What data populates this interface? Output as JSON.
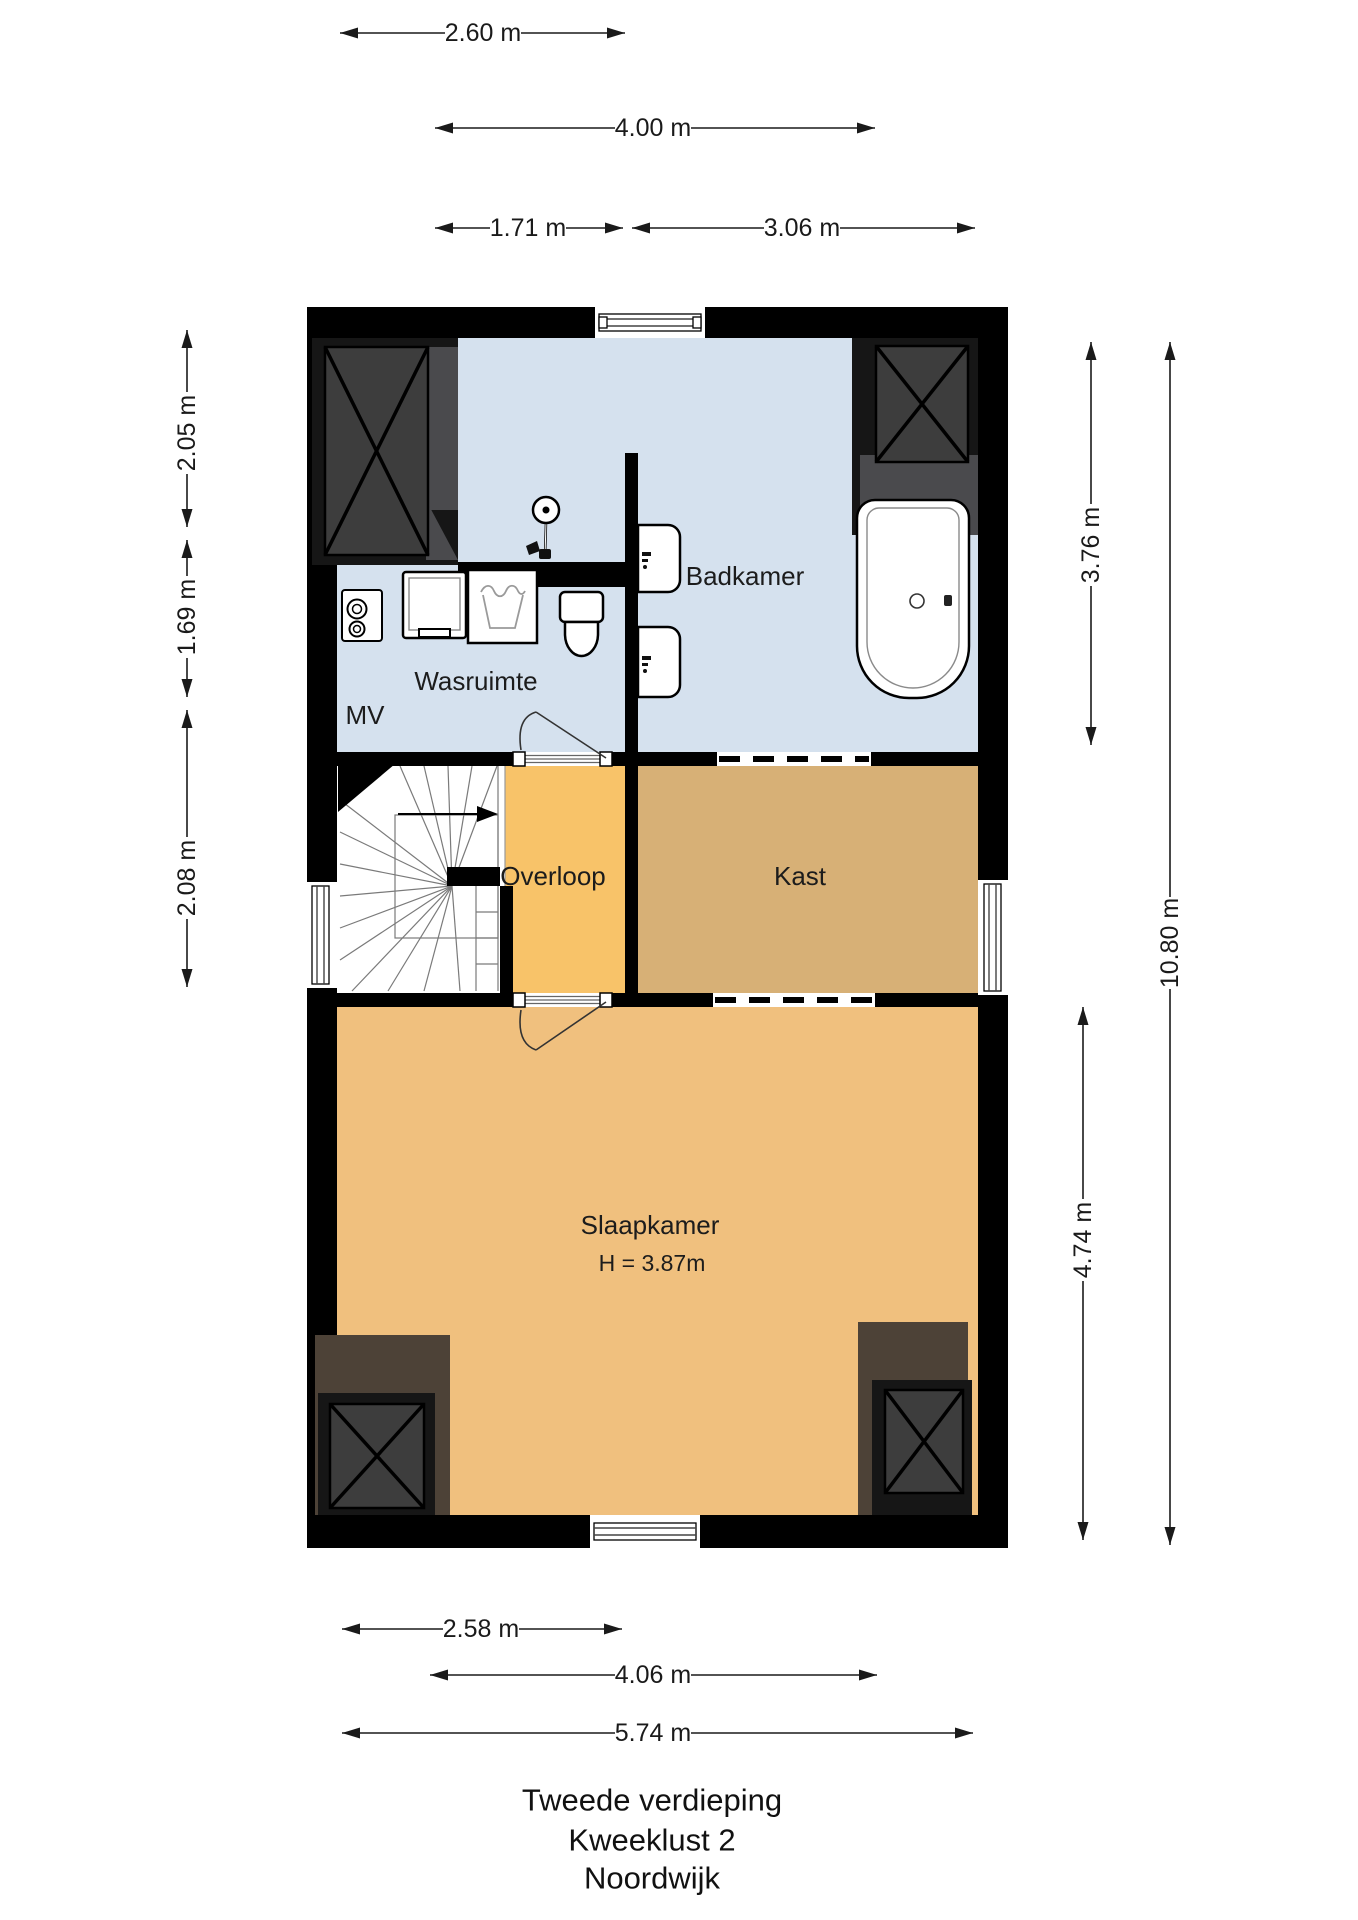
{
  "title": {
    "line1": "Tweede verdieping",
    "line2": "Kweeklust 2",
    "line3": "Noordwijk"
  },
  "rooms": {
    "badkamer": "Badkamer",
    "wasruimte": "Wasruimte",
    "mv": "MV",
    "overloop": "Overloop",
    "kast": "Kast",
    "slaapkamer": "Slaapkamer",
    "slaapkamer_height": "H = 3.87m"
  },
  "dimensions": {
    "top": [
      {
        "label": "2.60 m"
      },
      {
        "label": "4.00 m"
      },
      {
        "label": "1.71 m"
      },
      {
        "label": "3.06 m"
      }
    ],
    "left": [
      {
        "label": "2.05 m"
      },
      {
        "label": "1.69 m"
      },
      {
        "label": "2.08 m"
      }
    ],
    "right": [
      {
        "label": "3.76 m"
      },
      {
        "label": "10.80 m"
      },
      {
        "label": "4.74 m"
      }
    ],
    "bottom": [
      {
        "label": "2.58 m"
      },
      {
        "label": "4.06 m"
      },
      {
        "label": "5.74 m"
      }
    ]
  },
  "colors": {
    "wall": "#000000",
    "wet": "#d5e1ee",
    "overloop": "#f8c369",
    "kast": "#d7b076",
    "bed": "#f0c07e",
    "shaftframe": "#161616",
    "shaftbox": "#3d3d3d",
    "shaftshadow": "#4a4a4d",
    "shaftbrown": "#4d4237",
    "dim": "#1a1a1a"
  }
}
